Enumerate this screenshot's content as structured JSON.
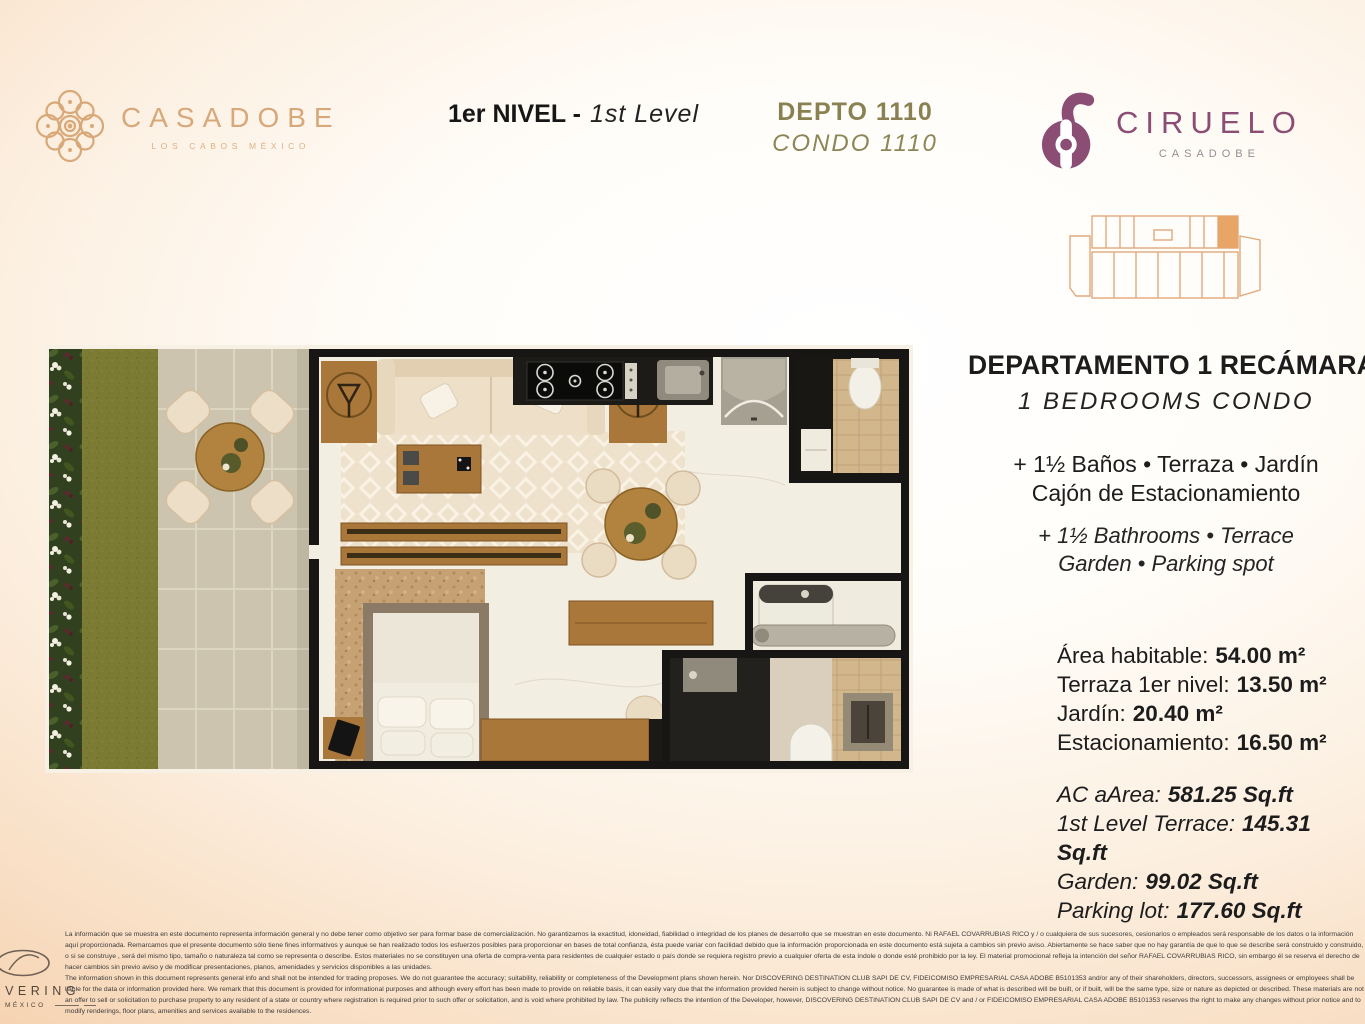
{
  "brand": {
    "casadobe": {
      "name": "CASADOBE",
      "tagline": "LOS CABOS MÉXICO"
    },
    "ciruelo": {
      "name": "CIRUELO",
      "sub": "CASADOBE"
    }
  },
  "header": {
    "level_es": "1er NIVEL -",
    "level_en": "1st Level",
    "unit_es": "DEPTO 1110",
    "unit_en": "CONDO 1110"
  },
  "details": {
    "title_es": "DEPARTAMENTO 1 RECÁMARA",
    "title_en": "1 BEDROOMS CONDO",
    "features_es_line1": "+ 1½ Baños • Terraza • Jardín",
    "features_es_line2": "Cajón de Estacionamiento",
    "features_en_line1": "+ 1½ Bathrooms • Terrace",
    "features_en_line2": "Garden • Parking spot",
    "areas_metric": [
      {
        "label": "Área habitable:",
        "value": "54.00 m²"
      },
      {
        "label": "Terraza 1er nivel:",
        "value": "13.50 m²"
      },
      {
        "label": "Jardín:",
        "value": "20.40 m²"
      },
      {
        "label": "Estacionamiento:",
        "value": "16.50 m²"
      }
    ],
    "areas_imperial": [
      {
        "label": "AC aArea:",
        "value": "581.25 Sq.ft"
      },
      {
        "label": "1st Level Terrace:",
        "value": "145.31 Sq.ft"
      },
      {
        "label": "Garden:",
        "value": "99.02 Sq.ft"
      },
      {
        "label": "Parking lot:",
        "value": "177.60 Sq.ft"
      }
    ]
  },
  "footer": {
    "logo_text": "DISCOVERING",
    "logo_sub": "MÉXICO",
    "disclaimer_es": "La información que se muestra en este documento representa información general y no debe tener como objetivo ser para formar base de comercialización. No garantizamos la exactitud, idoneidad, fiabilidad o integridad de los planes de desarrollo que se muestran en este documento.  Ni RAFAEL COVARRUBIAS RICO y / o cualquiera de sus sucesores, cesionarios o empleados será responsable de los datos o la información aquí proporcionada. Remarcamos que el presente documento sólo tiene fines informativos y aunque se han realizado todos los esfuerzos posibles para proporcionar en bases de total confianza, ésta puede variar con facilidad debido que la información proporcionada en este documento está sujeta a cambios sin previo aviso. Abiertamente se hace saber que no hay garantía de que lo que se describe será construido y construido, o si se construye , será del mismo tipo, tamaño o naturaleza tal como se representa o describe.  Estos materiales no se constituyen una oferta de compra-venta para residentes de cualquier estado o país donde se requiera registro previo a cualquier oferta de esta índole o donde esté prohibido por la ley. El material promocional refleja la intención del señor RAFAEL COVARRUBIAS RICO, sin embargo él se reserva el derecho de hacer cambios sin previo aviso y de modificar presentaciones, planos, amenidades y servicios disponibles a las unidades.",
    "disclaimer_en": "The information shown in this document represents general info and shall not be intended for trading proposes. We do not guarantee the accuracy; suitability, reliability or completeness of the Development plans shown herein. Nor DISCOVERING DESTINATION CLUB SAPI DE CV, FIDEICOMISO EMPRESARIAL CASA ADOBE B5101353 and/or any of their shareholders, directors, successors, assignees or employees shall be liable for the data or information provided here. We remark that this document is provided for informational purposes and although every effort has been made to provide on reliable basis, it can easily vary due that the information provided herein is subject to change without notice. No guarantee is made of what is described will be built, or if built, will be the same type, size or nature as depicted or described. These materials are not an offer to sell or solicitation to purchase property to any resident of a state or country where registration is required prior to such offer or solicitation, and is void where prohibited by law. The publicity reflects the intention of the Developer, however, DISCOVERING DESTINATION CLUB SAPI DE CV and / or FIDEICOMISO EMPRESARIAL CASA ADOBE B5101353 reserves the right to make any changes without prior notice and to modify renderings, floor plans, amenities and services available to the residences."
  },
  "colors": {
    "accent_gold": "#d9a87a",
    "accent_olive": "#8a8152",
    "accent_plum": "#8b4d74",
    "background_peach": "#f2c79e",
    "highlight_unit": "#e8a566"
  }
}
